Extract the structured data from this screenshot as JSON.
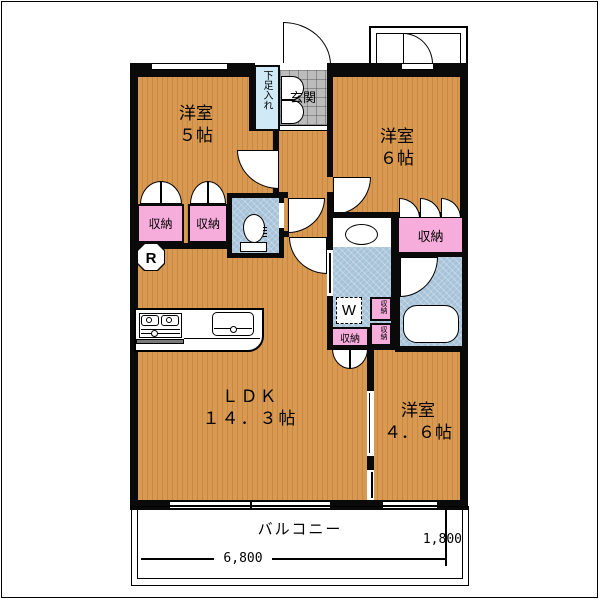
{
  "floorplan": {
    "rooms": {
      "western5": {
        "name": "洋室",
        "size": "５帖"
      },
      "western6": {
        "name": "洋室",
        "size": "６帖"
      },
      "western46": {
        "name": "洋室",
        "size": "４．６帖"
      },
      "ldk": {
        "name": "ＬＤＫ",
        "size": "１４．３帖"
      }
    },
    "entrance": {
      "label": "玄関"
    },
    "shoe_cabinet": {
      "label": "下足入れ"
    },
    "balcony": {
      "label": "バルコニー"
    },
    "closet_label": "収納",
    "appliances": {
      "refrigerator": "R",
      "washing_machine": "W"
    },
    "dimensions": {
      "main_width_mm": "6,800",
      "right_width_mm": "1,800"
    },
    "colors": {
      "floor_orange": "#d89a53",
      "wet_area_blue": "#a7c3d9",
      "closet_pink": "#f6addc",
      "entrance_gray": "#bcbcbc",
      "shoe_cabinet_blue": "#cfe9f6",
      "wall_black": "#0a0a0a"
    }
  }
}
